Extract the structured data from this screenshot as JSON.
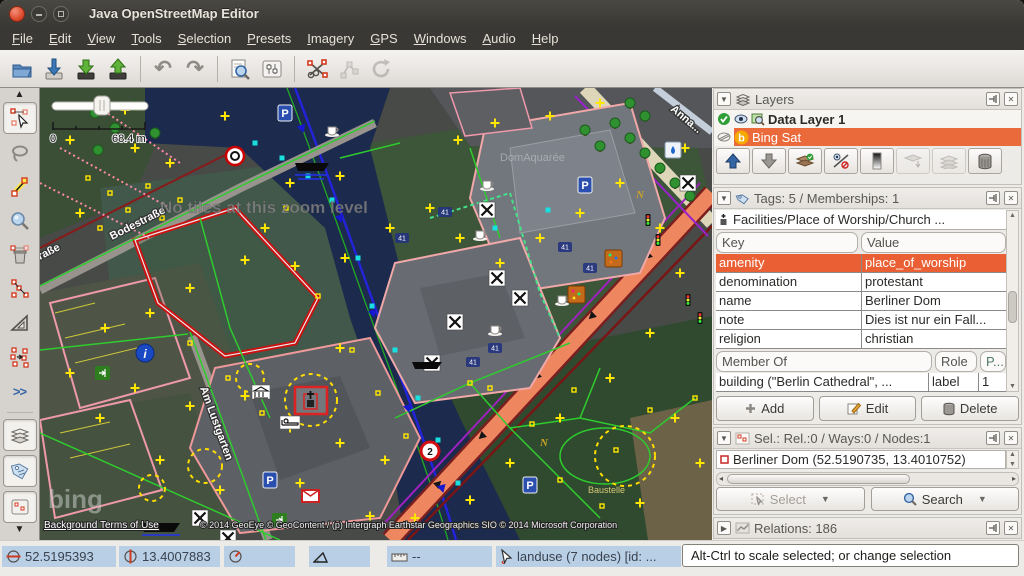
{
  "colors": {
    "titlebar": "#3a3834",
    "selection_orange": "#ea5f33",
    "status_blue": "#b9cfe6",
    "map_water": "#1c2a4d",
    "red_outline": "#cc1111"
  },
  "window": {
    "title": "Java OpenStreetMap Editor"
  },
  "menu": {
    "items": [
      "File",
      "Edit",
      "View",
      "Tools",
      "Selection",
      "Presets",
      "Imagery",
      "GPS",
      "Windows",
      "Audio",
      "Help"
    ]
  },
  "toolbar": {
    "icons": [
      "open-file",
      "download-data",
      "download-along",
      "upload-data",
      "undo",
      "redo",
      "search",
      "preferences",
      "split-way",
      "unglue-node",
      "refresh"
    ]
  },
  "sidetools": {
    "icons": [
      "select-tool",
      "lasso-tool",
      "draw-nodes-tool",
      "zoom-tool",
      "delete-tool",
      "merge-nodes-tool",
      "extrude-tool",
      "parallel-way-tool"
    ],
    "more": ">>",
    "toggles": [
      "toggle-layers",
      "toggle-tags",
      "toggle-selection"
    ]
  },
  "map": {
    "no_tiles": "No tiles at this zoom level",
    "scale_zero": "0",
    "scale_label": "68.4 m",
    "streets": {
      "bodestrasse": "Bodestraße",
      "am_lustgarten": "Am Lustgarten",
      "partial": "raße",
      "anna": "Anna..."
    },
    "labels": {
      "domaquaree": "DomAquarée",
      "baustelle": "Baustelle",
      "house_number": "41",
      "parking": "P",
      "info": "i",
      "sign_two": "2",
      "n_marker": "N"
    },
    "bing": {
      "logo": "bing",
      "terms": "Background Terms of Use",
      "attribution": "© 2014 GeoEye © GeoContent / (p) Intergraph Earthstar Geographics SIO © 2014 Microsoft Corporation"
    }
  },
  "panels": {
    "layers": {
      "title": "Layers",
      "rows": [
        {
          "name": "Data Layer 1"
        },
        {
          "name": "Bing Sat"
        }
      ],
      "button_icons": [
        "move-layer-up",
        "move-layer-down",
        "activate-layer",
        "show-hide-layer",
        "opacity",
        "merge-layer",
        "duplicate-layer",
        "delete-layer"
      ]
    },
    "tags": {
      "title": "Tags: 5 / Memberships: 1",
      "preset": "Facilities/Place of Worship/Church ...",
      "key_header": "Key",
      "value_header": "Value",
      "rows": [
        {
          "key": "amenity",
          "value": "place_of_worship"
        },
        {
          "key": "denomination",
          "value": "protestant"
        },
        {
          "key": "name",
          "value": "Berliner Dom"
        },
        {
          "key": "note",
          "value": "Dies ist nur ein Fall..."
        },
        {
          "key": "religion",
          "value": "christian"
        }
      ],
      "member_header": "Member Of",
      "role_header": "Role",
      "pos_header": "P...",
      "member_rows": [
        {
          "member": "building (\"Berlin Cathedral\", ...",
          "role": "label",
          "pos": "1"
        }
      ],
      "add": "Add",
      "edit": "Edit",
      "delete": "Delete"
    },
    "selection": {
      "title": "Sel.: Rel.:0 / Ways:0 / Nodes:1",
      "rows": [
        "Berliner Dom (52.5190735, 13.4010752)"
      ],
      "select": "Select",
      "search": "Search"
    },
    "relations": {
      "title": "Relations: 186"
    }
  },
  "status": {
    "lat": "52.5195393",
    "lon": "13.4007883",
    "ruler": "--",
    "object": "landuse (7 nodes) [id: ...",
    "hint": "Alt-Ctrl to scale selected; or change selection"
  }
}
